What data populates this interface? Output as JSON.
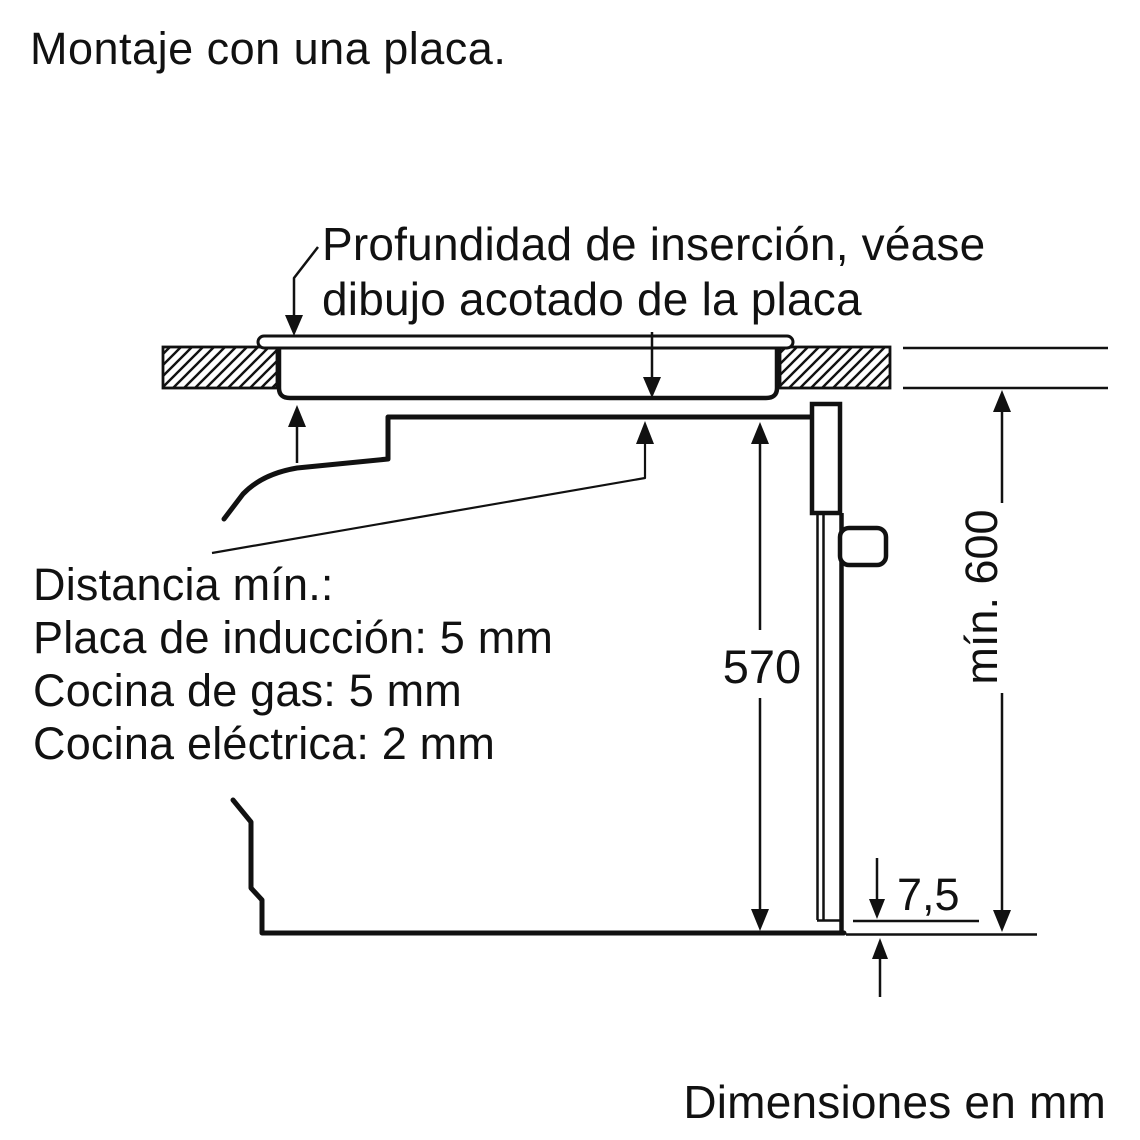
{
  "title": "Montaje con una placa.",
  "callouts": {
    "insertion": {
      "line1": "Profundidad de inserción, véase",
      "line2": "dibujo acotado de la placa"
    },
    "clearance": {
      "heading": "Distancia mín.:",
      "induction": "Placa de inducción: 5 mm",
      "gas": "Cocina de gas: 5 mm",
      "electric": "Cocina eléctrica: 2 mm"
    }
  },
  "dimensions": {
    "oven_niche_height": "570",
    "min_worktop_height": "mín. 600",
    "bottom_gap": "7,5"
  },
  "footer": {
    "units_note": "Dimensiones en mm"
  },
  "colors": {
    "ink": "#111111",
    "background": "#ffffff"
  }
}
